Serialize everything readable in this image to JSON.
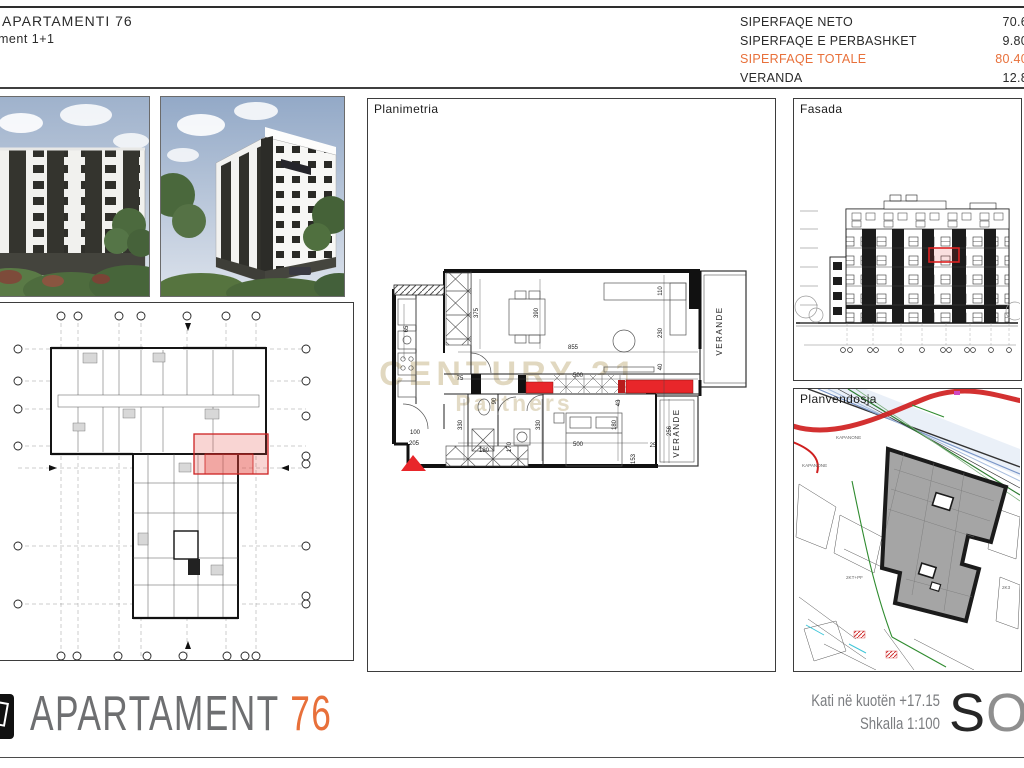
{
  "header": {
    "project_title": "APARTAMENTI  76",
    "apartment_type": "ment 1+1",
    "area_table": {
      "rows": [
        {
          "label": "SIPERFAQE NETO",
          "value": "70.6"
        },
        {
          "label": "SIPERFAQE E PERBASHKET",
          "value": "9.80"
        },
        {
          "label": "SIPERFAQE TOTALE",
          "value": "80.40"
        },
        {
          "label": "VERANDA",
          "value": "12.8"
        }
      ]
    }
  },
  "panels": {
    "planimetria": {
      "label": "Planimetria",
      "watermark_line1": "CENTURY 21",
      "watermark_line2": "Partners",
      "verande_top_label": "VERANDE",
      "verande_bottom_label": "VERANDE",
      "dims": [
        "375",
        "390",
        "855",
        "110",
        "230",
        "500",
        "90",
        "75",
        "330",
        "330",
        "180",
        "256",
        "170",
        "500",
        "180",
        "153",
        "43",
        "205",
        "100",
        "25",
        "65",
        "40"
      ]
    },
    "fasada": {
      "label": "Fasada"
    },
    "planvendosje": {
      "label": "Planvendosja",
      "site_labels": [
        "KAPANONE",
        "KAPANONE",
        "2KT+PF",
        "2K3"
      ]
    }
  },
  "footer": {
    "logo_title": "APARTAMENT",
    "logo_number": "76",
    "note_line1": "Kati në kuotën +17.15",
    "note_line2": "Shkalla 1:100",
    "brand_letter_s": "S",
    "brand_letter_o": "O"
  },
  "colors": {
    "accent_orange": "#e8703a",
    "watermark_gold": "#c9b98e",
    "highlight_red": "#e8262a",
    "site_road_red": "#cf1f1f",
    "footprint_gray": "#a5a5a5",
    "text_gray": "#6e6f71"
  }
}
